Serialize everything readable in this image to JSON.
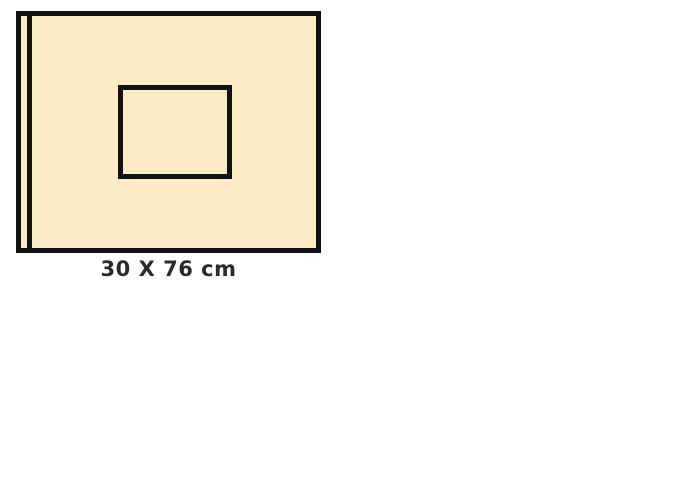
{
  "diagram": {
    "label": "30 X 76 cm",
    "colors": {
      "background": "#FFFFFF",
      "fill": "#FBECC6",
      "border": "#111111",
      "label_text": "#2B2B2B"
    }
  }
}
